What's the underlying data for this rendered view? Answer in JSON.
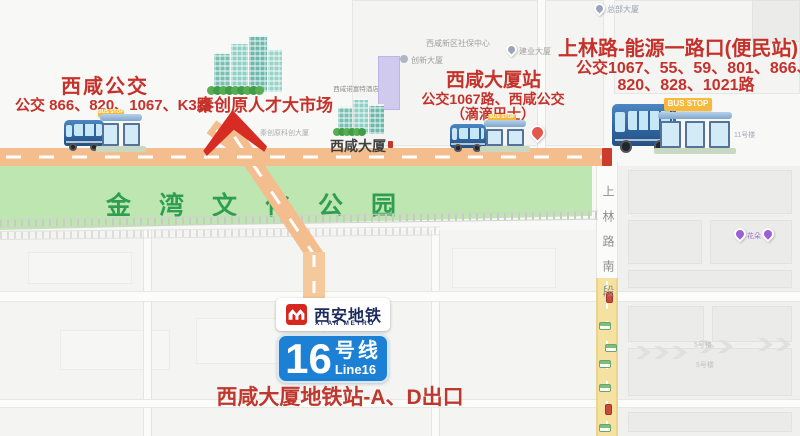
{
  "stops": {
    "xixian_bus": {
      "title": "西咸公交",
      "routes": "公交 866、820、1067、K3路"
    },
    "daxia": {
      "title": "西咸大厦站",
      "routes": "公交1067路、西咸公交",
      "note": "（滴滴巴士）"
    },
    "shanglin": {
      "title": "上林路-能源一路口(便民站)",
      "routes1": "公交1067、55、59、801、866、",
      "routes2": "820、828、1021路"
    }
  },
  "market": {
    "title": "秦创原人才大市场",
    "sub": "秦创原科创大厦"
  },
  "metro": {
    "name_cn": "西安地铁",
    "name_en": "XI'AN METRO",
    "line_number": "16",
    "line_suffix": "号线",
    "line_en": "Line16",
    "exit_label": "西咸大厦地铁站-A、D出口"
  },
  "map": {
    "park_name": "金湾文化公园",
    "building_label": "西咸大厦",
    "hotel_label": "西咸诺富特酒店",
    "road_label": "上林路南段",
    "bus_stop_sign": "BUS STOP",
    "pois": {
      "shebao": "西咸新区社保中心",
      "chuangxin": "创新大厦",
      "jianye": "建业大厦",
      "hq": "总部大厦",
      "flower": "花朵",
      "bldg5": "5号楼",
      "bldg11": "11号楼"
    }
  },
  "colors": {
    "label_red": "#C5322B",
    "park_green_bg": "#BEE6B0",
    "park_green_text": "#2F9E50",
    "road_orange": "#F3BD8D",
    "road_yellow": "#F6E2A0",
    "line_blue": "#1C80D4",
    "metro_navy": "#1C2B5E",
    "metro_red": "#D6281E",
    "bus_stop_yellow": "#F6B93B"
  }
}
